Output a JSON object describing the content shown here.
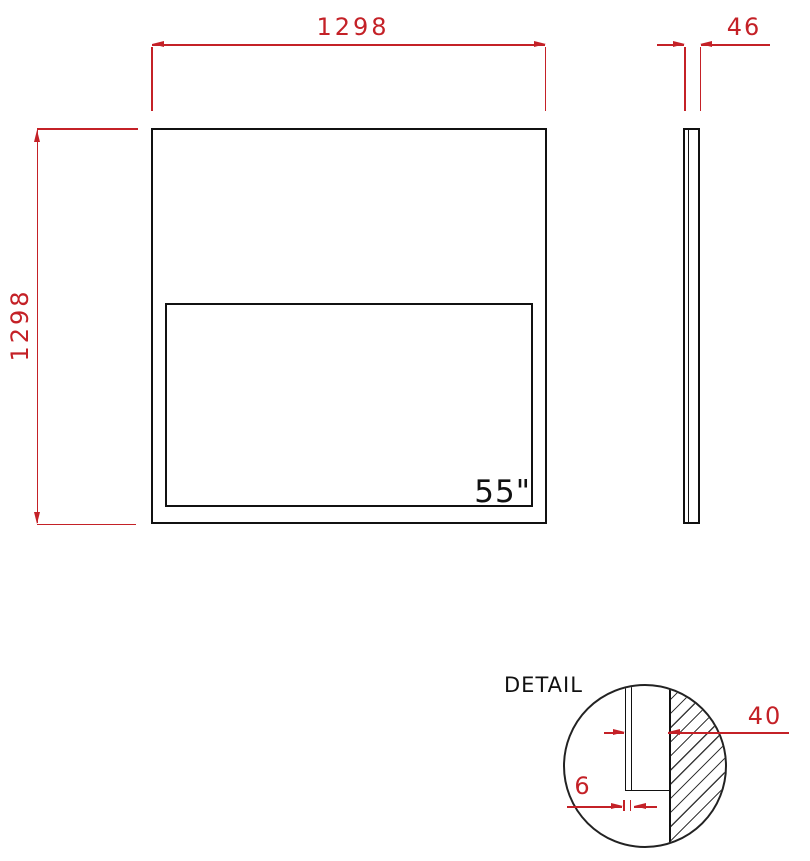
{
  "drawing": {
    "type": "technical-dimension-drawing",
    "units_note": "",
    "colors": {
      "dimension": "#c42127",
      "outline": "#111111",
      "background": "#ffffff"
    },
    "front_view": {
      "width_label": "1298",
      "height_label": "1298",
      "screen_size": "55\""
    },
    "side_view": {
      "thickness_label": "46"
    },
    "detail_view": {
      "title": "DETAIL",
      "depth_label": "40",
      "glass_thickness_label": "6"
    }
  }
}
